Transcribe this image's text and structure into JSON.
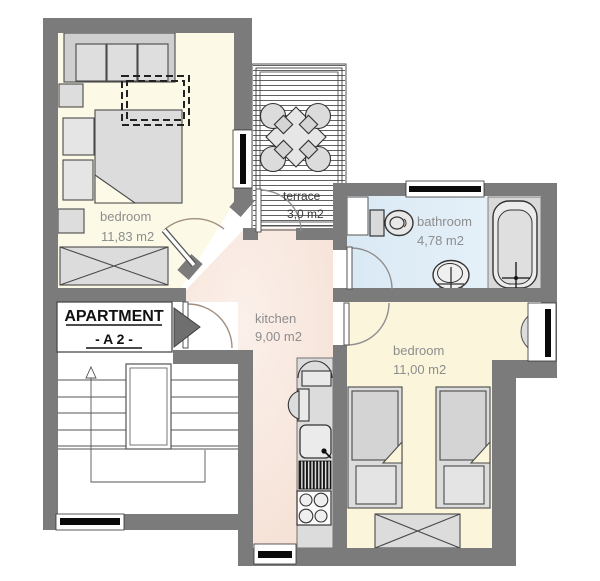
{
  "title": "Apartment A2 floor plan",
  "apartment_label": {
    "line1": "APARTMENT",
    "line2": "- A 2 -"
  },
  "rooms": {
    "bedroom1": {
      "name": "bedroom",
      "area": "11,83 m2"
    },
    "terrace": {
      "name": "terrace",
      "area": "3,0 m2"
    },
    "bathroom": {
      "name": "bathroom",
      "area": "4,78 m2"
    },
    "kitchen": {
      "name": "kitchen",
      "area": "9,00 m2"
    },
    "bedroom2": {
      "name": "bedroom",
      "area": "11,00 m2"
    }
  },
  "colors": {
    "wall": "#7b7b7b",
    "bedroom1_fill": "#FCFAE6",
    "bedroom2_fill": "#FAF5DB",
    "kitchen_fill": "#F8E7DC",
    "bathroom_fill": "#DEEBF5",
    "furniture_fill": "#DCDCDC",
    "outline": "#4a4a4a",
    "label_gray": "#8d8d8d"
  }
}
